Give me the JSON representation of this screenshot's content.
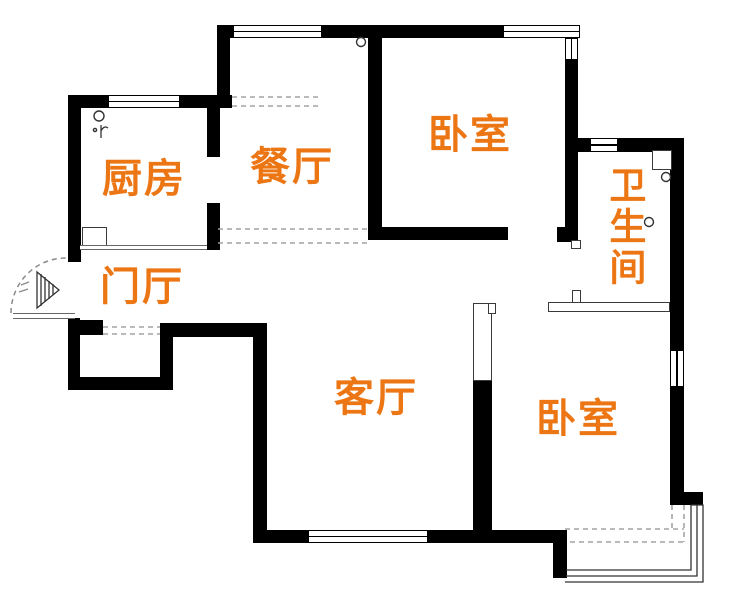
{
  "plan": {
    "background": "#ffffff",
    "wall_color": "#000000",
    "label_color": "#ed7614",
    "labels": {
      "kitchen": "厨房",
      "dining": "餐厅",
      "bedroom_north": "卧室",
      "bathroom": "卫生间",
      "entry_hall": "门厅",
      "living_room": "客厅",
      "bedroom_south": "卧室"
    }
  }
}
